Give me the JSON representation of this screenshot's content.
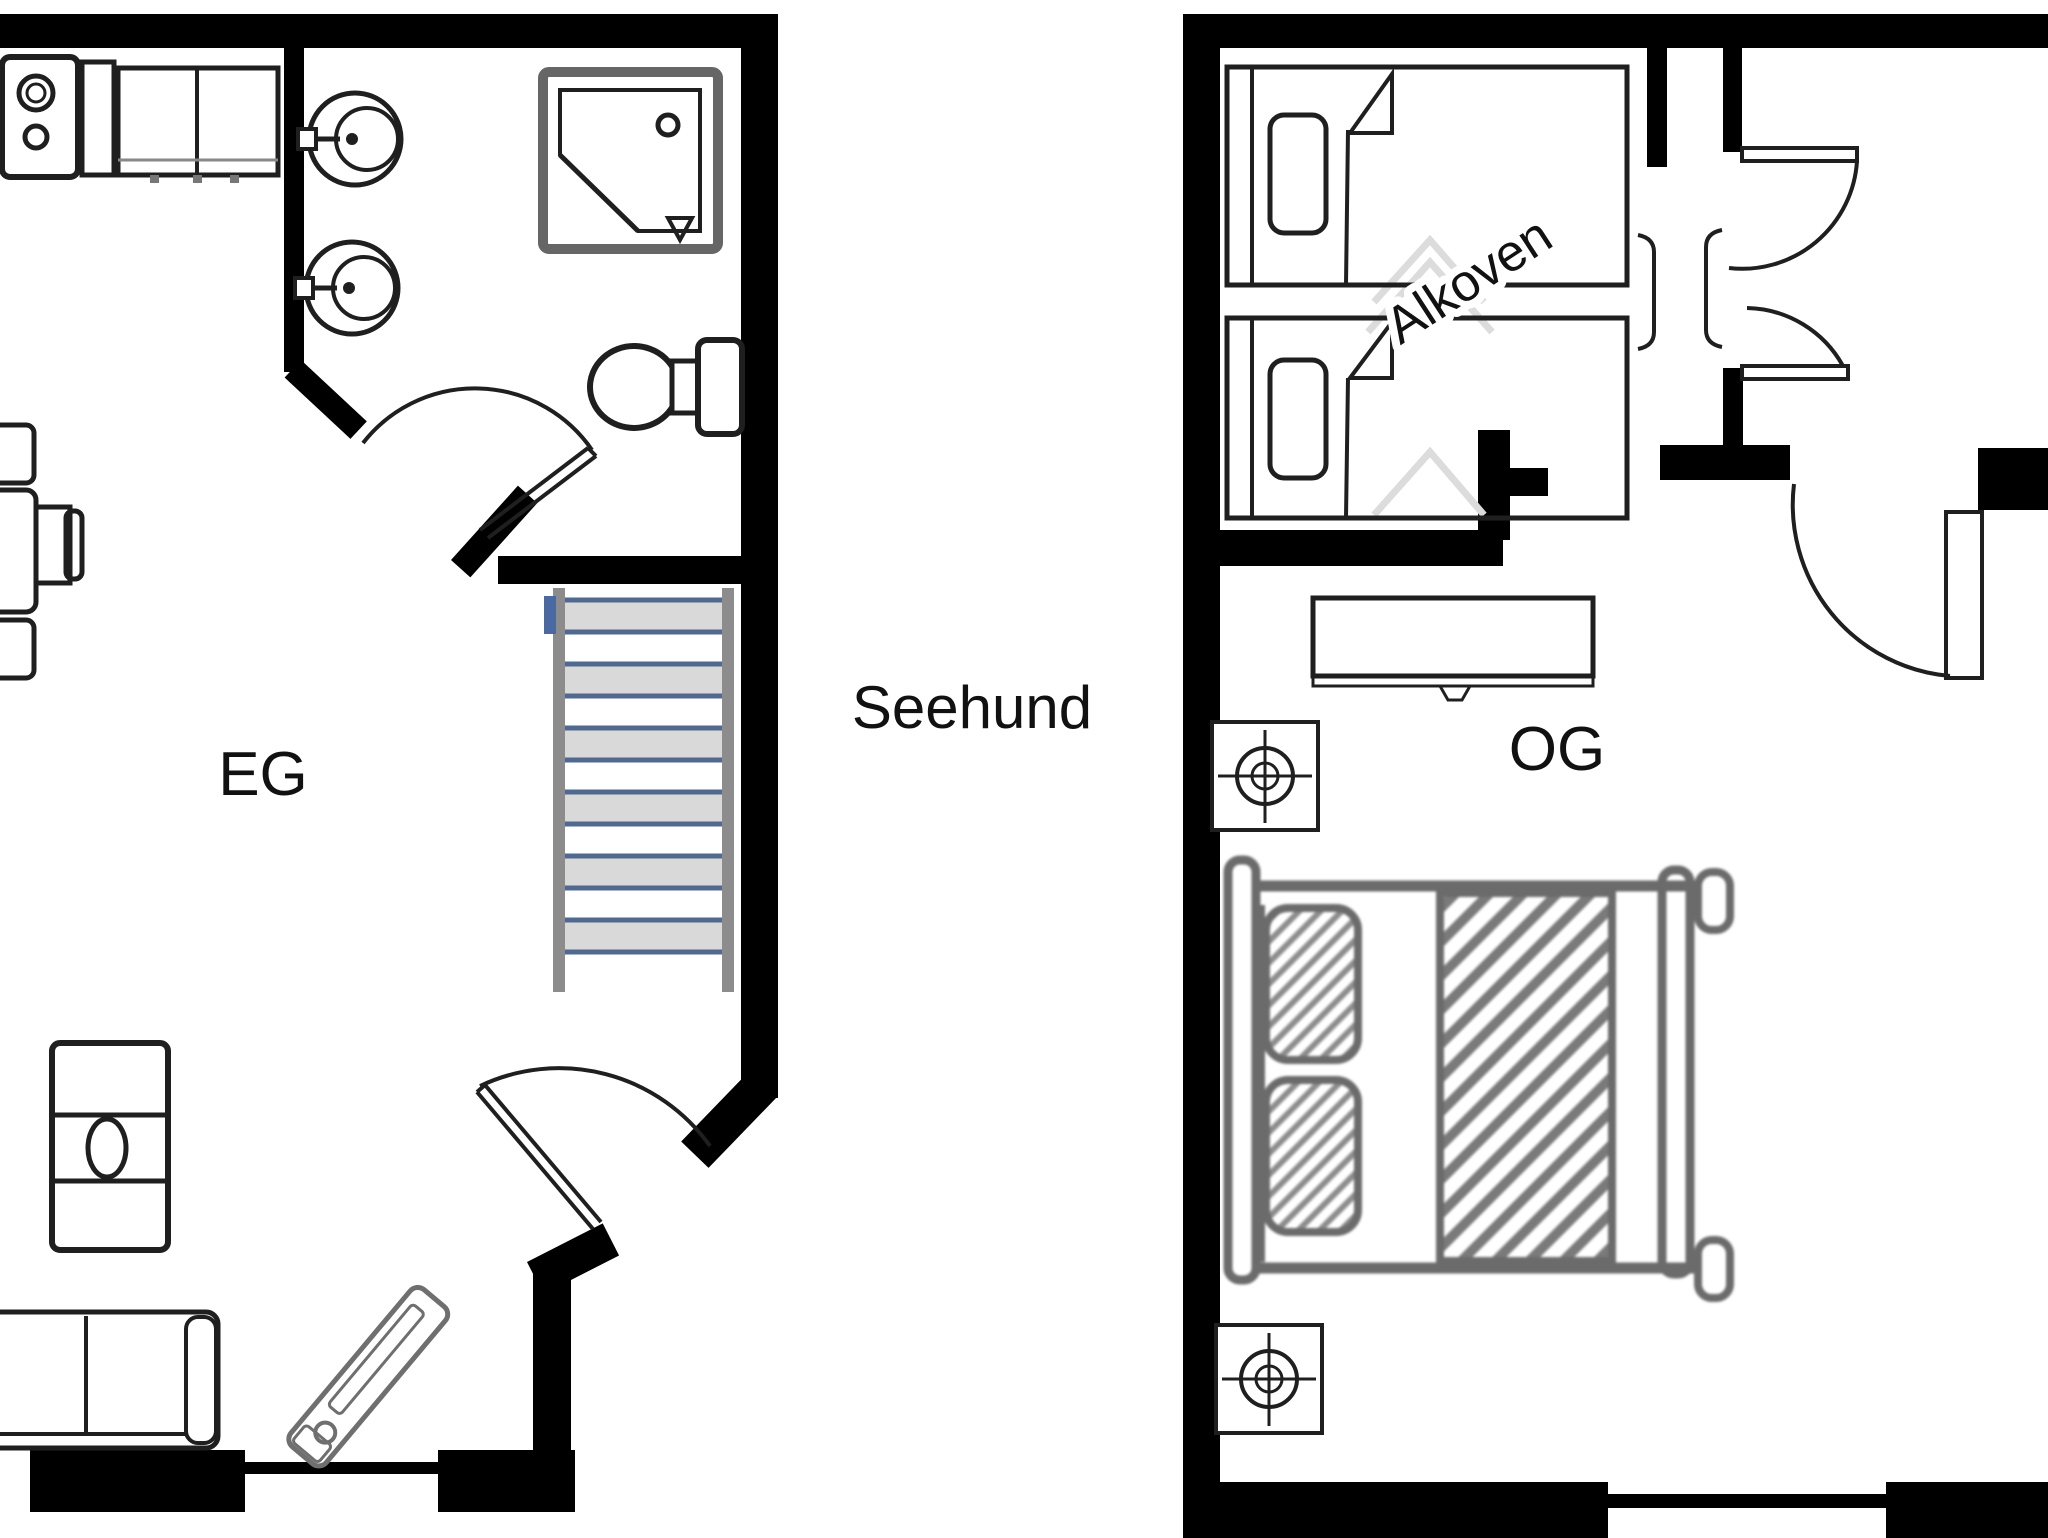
{
  "title": "Ferienhaus Seehund Grundriss",
  "labels": {
    "left_floor": "EG",
    "right_floor": "OG",
    "house_name": "Seehund",
    "alcove": "Alkoven"
  },
  "stairs": {
    "step_count": 12,
    "x1": 565,
    "x2": 722,
    "y_top": 600,
    "step_pitch": 32,
    "line_color": "#51688f",
    "tread_fill": "#d9d9d9",
    "rail_color": "#8c8c8c",
    "marker_color": "#4a69a0"
  },
  "colors": {
    "wall": "#000000",
    "outline": "#1f1f1f",
    "fixture_gray": "#6f6f6f",
    "bed_gray": "#6b6b6b",
    "faint_watermark": "#dcdcdc"
  },
  "eg": {
    "label": "EG",
    "furniture": [
      "stove",
      "kitchen-counter",
      "washbasin",
      "washbasin",
      "shower",
      "toilet",
      "staircase",
      "dining-table",
      "chair",
      "chair",
      "chair",
      "cabinet",
      "sofa",
      "sideboard"
    ],
    "doors": [
      "bathroom-door",
      "entrance-door"
    ]
  },
  "og": {
    "label": "OG",
    "furniture": [
      "single-bed",
      "single-bed",
      "dresser",
      "double-bed",
      "ceiling-light-symbol",
      "ceiling-light-symbol"
    ],
    "doors": [
      "room-door",
      "room-door",
      "entry-door"
    ]
  }
}
